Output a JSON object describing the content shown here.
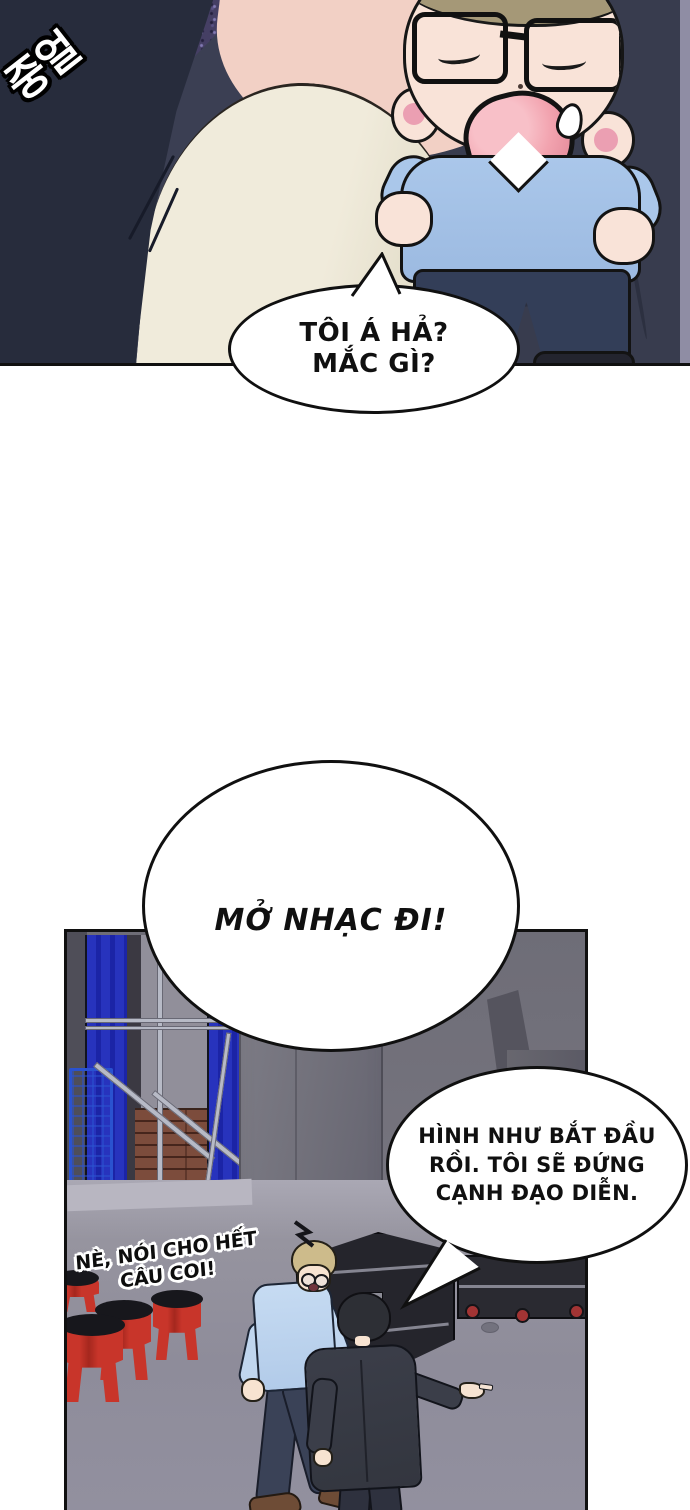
{
  "page": {
    "type": "webtoon-comic-page",
    "background": "#ffffff"
  },
  "sfx": {
    "korean": "중얼"
  },
  "speech": {
    "b1": {
      "l1": "TÔI Á HẢ?",
      "l2": "MẮC GÌ?"
    },
    "b2": {
      "l1": "MỞ NHẠC ĐI!"
    },
    "b3": {
      "l1": "HÌNH NHƯ BẮT ĐẦU",
      "l2": "RỒI. TÔI SẼ ĐỨNG",
      "l3": "CẠNH ĐẠO DIỄN."
    },
    "shout": {
      "l1": "NÈ, NÓI CHO HẾT",
      "l2": "CÂU COI!"
    }
  },
  "colors": {
    "panel_dark_bg": "#3b3f53",
    "sparkle_purple": "#453f64",
    "jacket_navy": "#272c3c",
    "shirt_cream": "#f0ebdb",
    "chibi_sweater_blue": "#aac7ea",
    "curtain_blue": "#2733bd",
    "brick_brown": "#7c4c3c",
    "stool_red": "#c8352a",
    "case_black": "#25252c",
    "wheel_red": "#a23434",
    "floor_gray": "#8e8c9a",
    "sweater_light_blue": "#c6dbf2",
    "suit_dark": "#3b3e49"
  }
}
